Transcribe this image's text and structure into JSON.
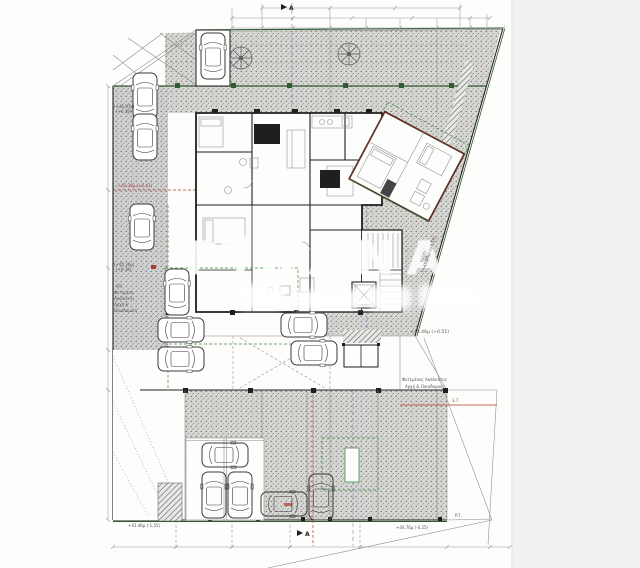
{
  "watermark": {
    "text": "PIKANA"
  },
  "labels": {
    "elev_top_left_1": "(+45.07μ)",
    "elev_top_left_2": "(+0.38)",
    "elev_mid_left_1": "(+45.36μ)",
    "elev_mid_left_2": "(+0.38)",
    "note_left_1": "ΥΠ.",
    "note_left_2": "Φυτεμένη",
    "note_left_3": "Ακάλυπτη",
    "note_left_4": "Αρχή &",
    "note_left_5": "Οικοδομική",
    "elev_left_red": "+45.36μ (+0.41)",
    "elev_right": "+45.46μ (+0.51)",
    "note_right_1": "Φυτεμένος Ακάλυπτος",
    "note_right_2": "Αρχή & Οικοδομική",
    "elev_diagonal": "(+45.36μ) (+0.55)",
    "elev_bottom_left": "+43.46μ (-1.55)",
    "elev_bottom_right": "+44.76μ (-0.25)",
    "dim_red": "3.7",
    "dim_p7": "P.7",
    "section_marker": "A"
  },
  "colors": {
    "paper": "#fdfdfc",
    "margin": "#f1f1ef",
    "wall": "#1f1f1f",
    "wing_wall": "#5f2f26",
    "thin": "#8a8a8a",
    "dim": "#9a9a9a",
    "green": "#2f5b2f",
    "green_bright": "#3c8a3c",
    "red": "#b23a2e",
    "purple": "#8a7cc0",
    "label": "#555555",
    "watermark": "#ffffff",
    "car": "#3a3a3a"
  }
}
